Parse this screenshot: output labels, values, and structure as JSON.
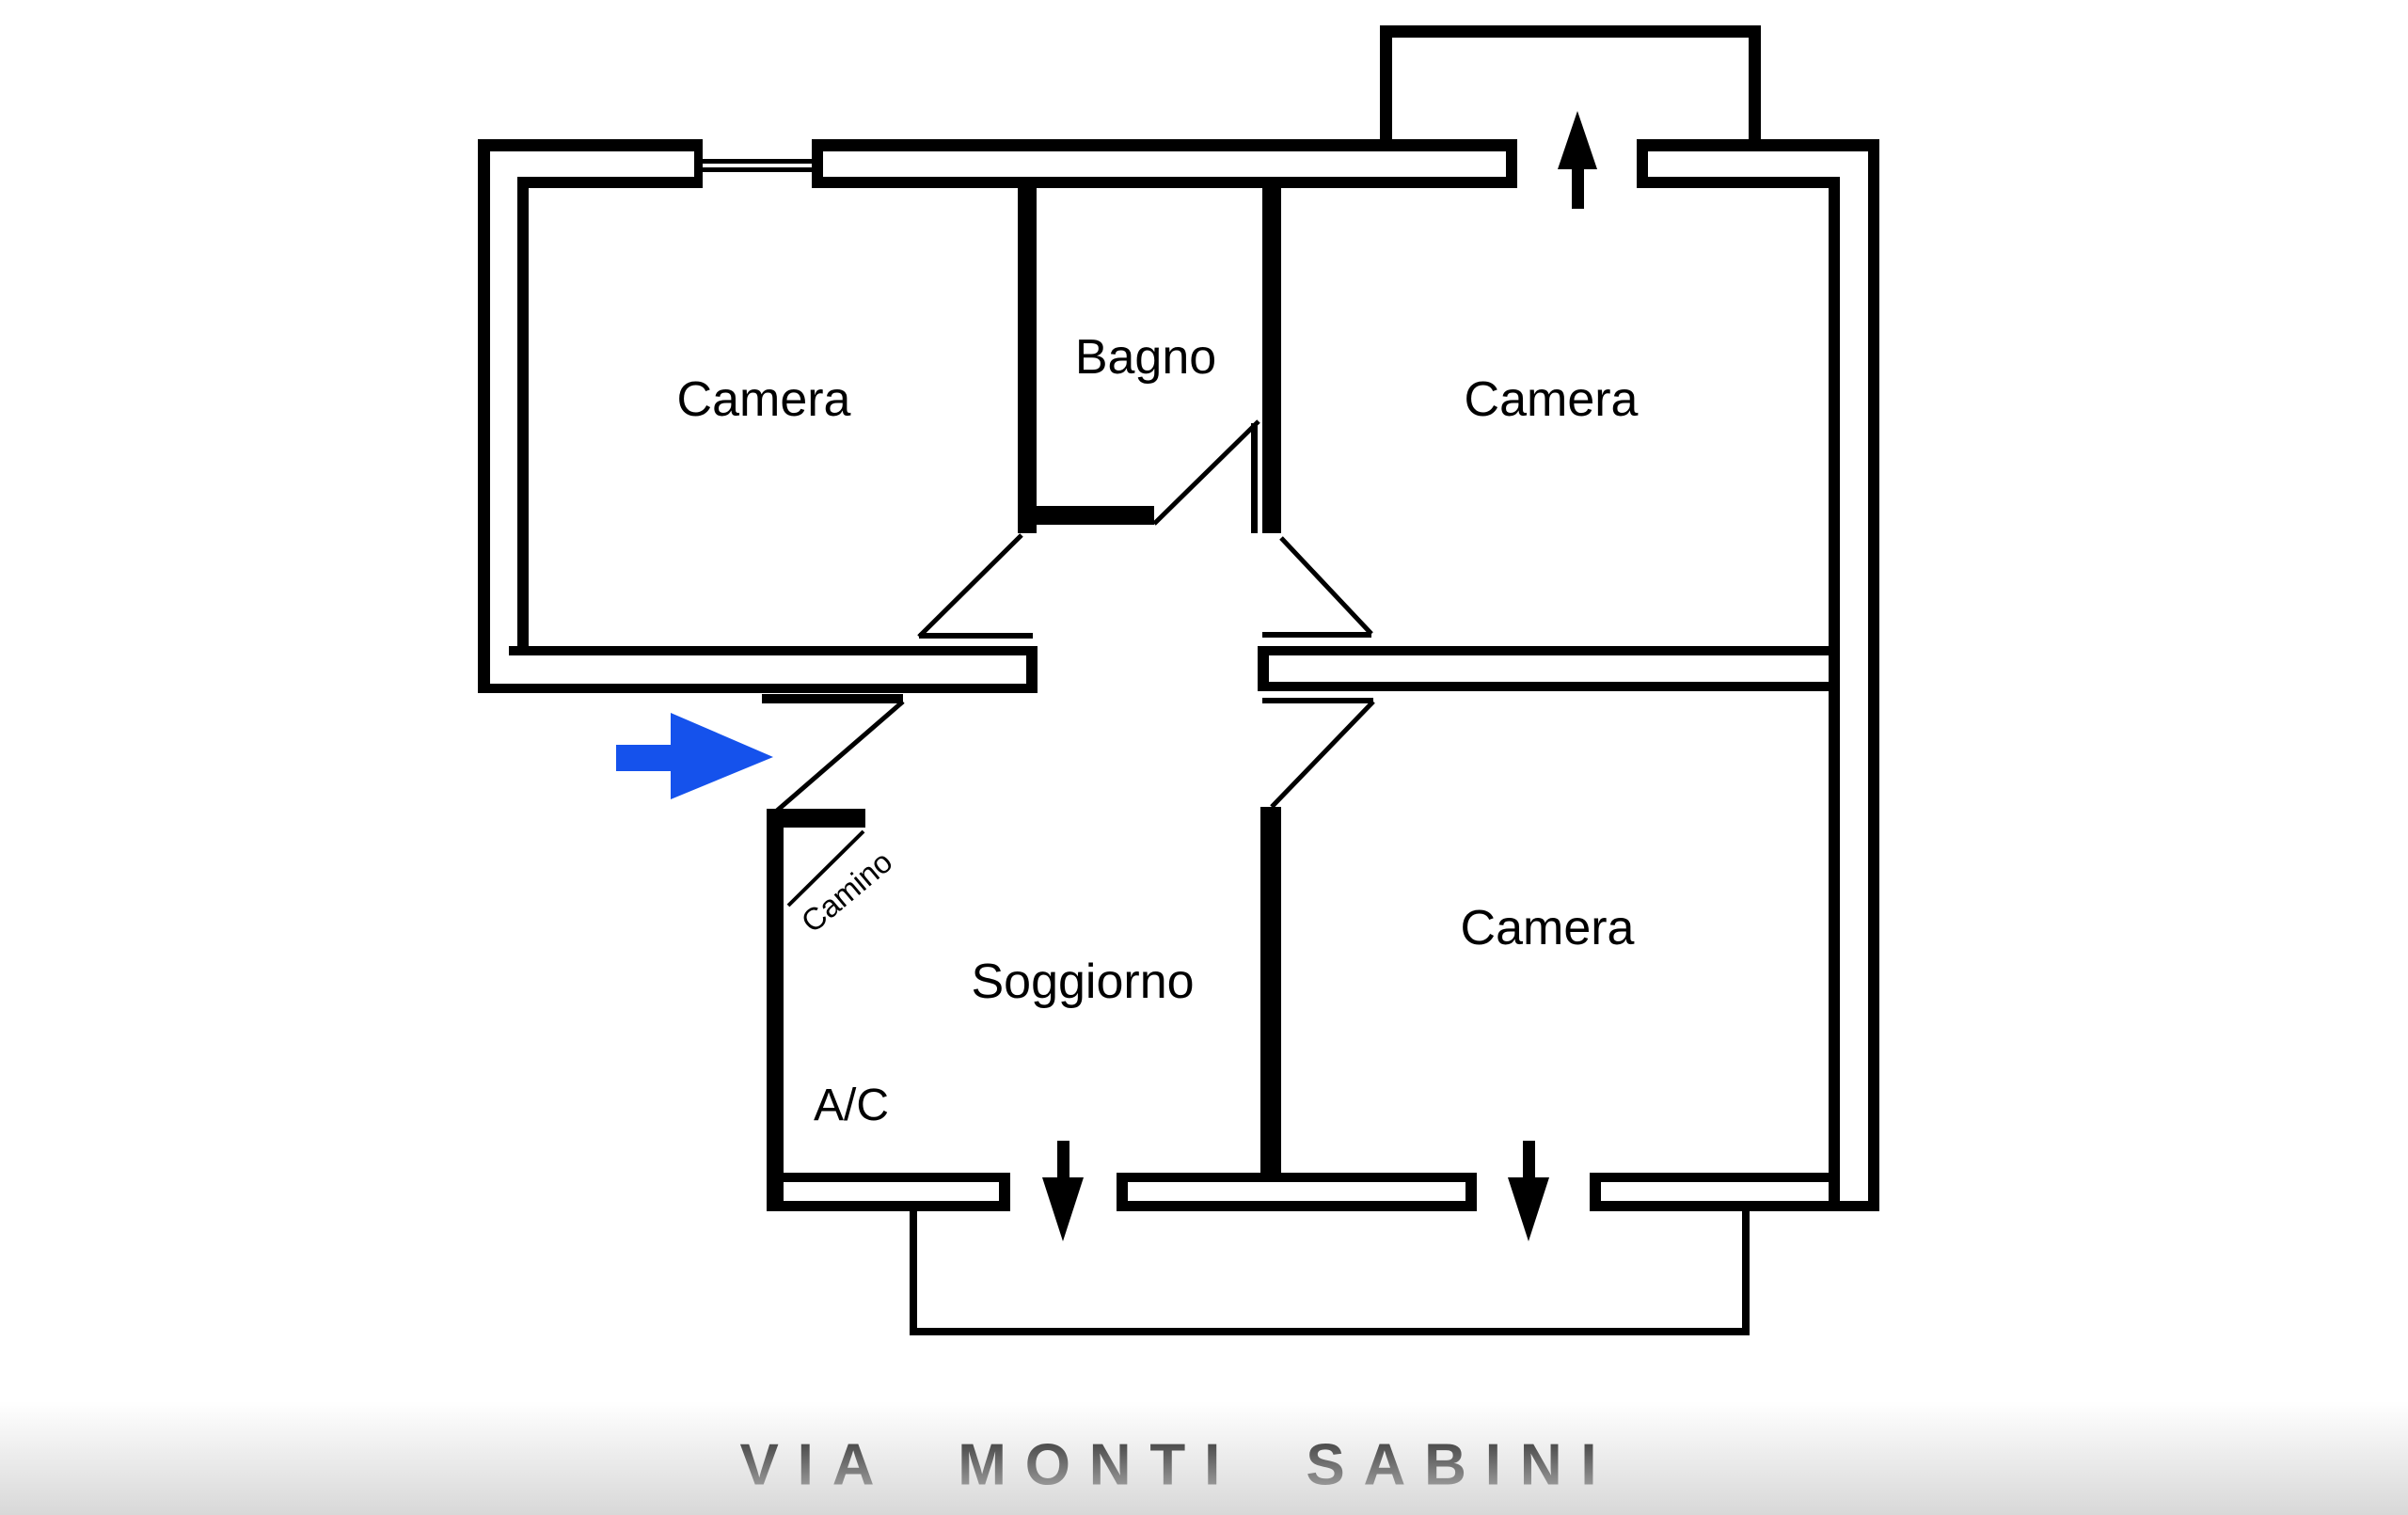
{
  "floor_plan": {
    "rooms": {
      "camera_top_left": "Camera",
      "bagno": "Bagno",
      "camera_top_right": "Camera",
      "camera_bottom_right": "Camera",
      "soggiorno": "Soggiorno"
    },
    "annotations": {
      "fireplace": "Camino",
      "ac_unit": "A/C"
    },
    "street_label": "VIA MONTI SABINI",
    "icons": {
      "entrance": "right-arrow",
      "balcony_top_access": "up-arrow",
      "balcony_bottom_access_left": "down-arrow",
      "balcony_bottom_access_right": "down-arrow"
    },
    "colors": {
      "walls": "#000000",
      "entrance_arrow": "#1552ec",
      "background": "#ffffff"
    }
  }
}
